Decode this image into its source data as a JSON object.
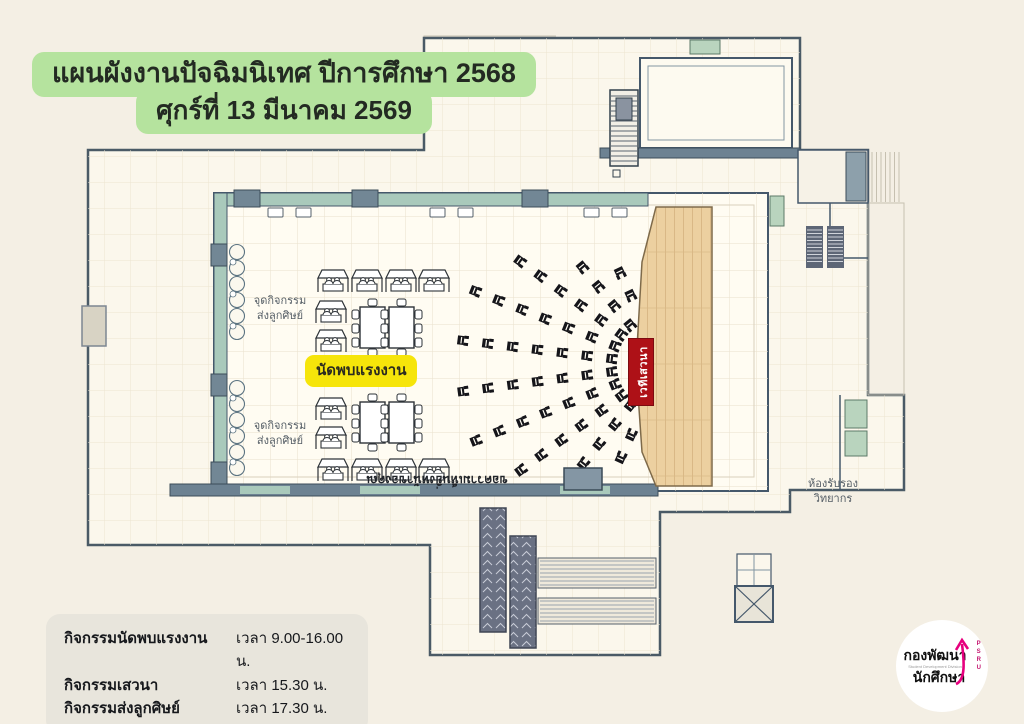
{
  "title": {
    "line1": "แผนผังงานปัจฉิมนิเทศ ปีการศึกษา 2568",
    "line2": "ศุกร์ที่ 13 มีนาคม 2569"
  },
  "plan": {
    "stage_label": "เวทีเสวนา",
    "job_fair_label": "นัดพบแรงงาน",
    "farewell_point_line1": "จุดกิจกรรม",
    "farewell_point_line2": "ส่งลูกศิษย์",
    "speaker_room_line1": "ห้องรับรอง",
    "speaker_room_line2": "วิทยากร",
    "hall_note": "ขอความเห็นยิ่งหน้าของคุณ"
  },
  "schedule": {
    "rows": [
      {
        "activity": "กิจกรรมนัดพบแรงงาน",
        "time": "เวลา 9.00-16.00 น."
      },
      {
        "activity": "กิจกรรมเสวนา",
        "time": "เวลา 15.30 น."
      },
      {
        "activity": "กิจกรรมส่งลูกศิษย์",
        "time": "เวลา 17.30 น."
      }
    ]
  },
  "logo": {
    "line1": "กองพัฒนา",
    "line2": "นักศึกษา",
    "subtext": "Student Development Division",
    "acronym": "PSRU"
  },
  "colors": {
    "background": "#f4efe4",
    "title_highlight": "#b5e39e",
    "job_fair_yellow": "#f6e50a",
    "stage_red": "#ae1117",
    "wall_teal": "#a9c9bb",
    "wall_gray": "#6d8292",
    "wood_floor": "#ecd0a0",
    "logo_pink": "#e6007e"
  },
  "icons": {
    "booth": "canopy-booth-icon",
    "audience_chair": "chair-icon",
    "table": "table-icon",
    "escalator": "escalator-icon",
    "elevator": "elevator-icon",
    "stairs": "stairs-icon",
    "logo_arrow": "pink-arrow-icon"
  }
}
